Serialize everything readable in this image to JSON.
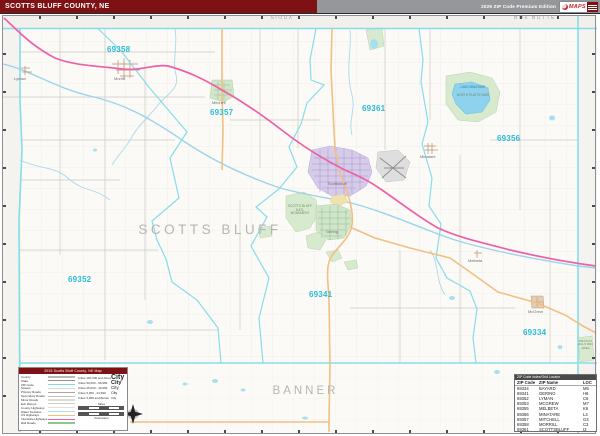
{
  "header": {
    "title": "SCOTTS BLUFF COUNTY, NE",
    "edition": "2026 ZIP Code Premium Edition",
    "logo_text": "MAPS"
  },
  "map": {
    "county_label": "SCOTTS BLUFF",
    "neighbors": [
      {
        "name": "SIOUX"
      },
      {
        "name": "BOX BUTTE"
      },
      {
        "name": "BANNER"
      }
    ],
    "zip_labels": [
      {
        "text": "69358"
      },
      {
        "text": "69357"
      },
      {
        "text": "69361"
      },
      {
        "text": "69356"
      },
      {
        "text": "69352"
      },
      {
        "text": "69341"
      },
      {
        "text": "69334"
      }
    ],
    "towns": [
      {
        "name": "Morrill"
      },
      {
        "name": "Mitchell"
      },
      {
        "name": "Scottsbluff"
      },
      {
        "name": "Gering"
      },
      {
        "name": "Minatare"
      },
      {
        "name": "McGrew"
      },
      {
        "name": "Melbeta"
      },
      {
        "name": "Lyman"
      }
    ],
    "poi": [
      {
        "name": "LAKE MINATARE"
      },
      {
        "name": "NORTH PLATTE NWR"
      },
      {
        "name": "SCOTTS BLUFF NATL MONUMENT"
      },
      {
        "name": "WILDCAT HILLS REC AREA"
      }
    ]
  },
  "legend": {
    "title": "2026 Scotts Bluff County, NE Map",
    "items": [
      {
        "label": "County",
        "color": "#b9b9b9"
      },
      {
        "label": "State",
        "color": "#8f8f8f"
      },
      {
        "label": "ZIP Code",
        "color": "#7fd9e8"
      },
      {
        "label": "Streets",
        "color": "#d9d7d2"
      },
      {
        "label": "Primary Roads",
        "color": "#a9a7a2"
      },
      {
        "label": "Secondary Roads",
        "color": "#c2c0bb"
      },
      {
        "label": "Minor Roads",
        "color": "#dcdad5"
      },
      {
        "label": "Exit Ramps",
        "color": "#cfcdc8"
      },
      {
        "label": "County Highways",
        "color": "#eed9db"
      },
      {
        "label": "Water Features",
        "color": "#a8dff0"
      },
      {
        "label": "US Highways",
        "color": "#f2bf83"
      },
      {
        "label": "Interstate Highways",
        "color": "#ee5fa5"
      },
      {
        "label": "Rail Roads",
        "color": "#8cc88c"
      }
    ],
    "city_classes": [
      {
        "label": "Cities 100,000 and Above",
        "sample": "City"
      },
      {
        "label": "Cities 50,000 - 99,999",
        "sample": "City"
      },
      {
        "label": "Cities 25,000 - 49,999",
        "sample": "City"
      },
      {
        "label": "Cities 5,000 - 24,999",
        "sample": "City"
      },
      {
        "label": "Cities 4,999 and Below",
        "sample": "City"
      }
    ],
    "scale": {
      "miles_label": "Miles",
      "km_label": "Kilometers"
    }
  },
  "table": {
    "title": "ZIP Code Index/Grid Locator",
    "columns": [
      "ZIP Code",
      "ZIP Name",
      "LOC"
    ],
    "rows": [
      {
        "zip": "69334",
        "name": "BAYARD",
        "loc": "M5"
      },
      {
        "zip": "69341",
        "name": "GERING",
        "loc": "H6"
      },
      {
        "zip": "69352",
        "name": "LYMAN",
        "loc": "C6"
      },
      {
        "zip": "69353",
        "name": "MCGREW",
        "loc": "M7"
      },
      {
        "zip": "69355",
        "name": "MELBETA",
        "loc": "K6"
      },
      {
        "zip": "69356",
        "name": "MINATARE",
        "loc": "L3"
      },
      {
        "zip": "69357",
        "name": "MITCHELL",
        "loc": "G3"
      },
      {
        "zip": "69358",
        "name": "MORRILL",
        "loc": "C3"
      },
      {
        "zip": "69361",
        "name": "SCOTTSBLUFF",
        "loc": "I3"
      }
    ]
  },
  "colors": {
    "header_maroon": "#7e1113",
    "header_gray": "#95979a",
    "zip_boundary": "#86dcea",
    "zip_label": "#2bbbd8",
    "interstate_pink": "#ee5fa5",
    "us_highway_orange": "#f2bf83",
    "water_blue": "#8fd2ee",
    "city_green": "#cfe6c9",
    "city_purple": "#d6cbe9",
    "county_label_gray": "#b5b5b5"
  }
}
